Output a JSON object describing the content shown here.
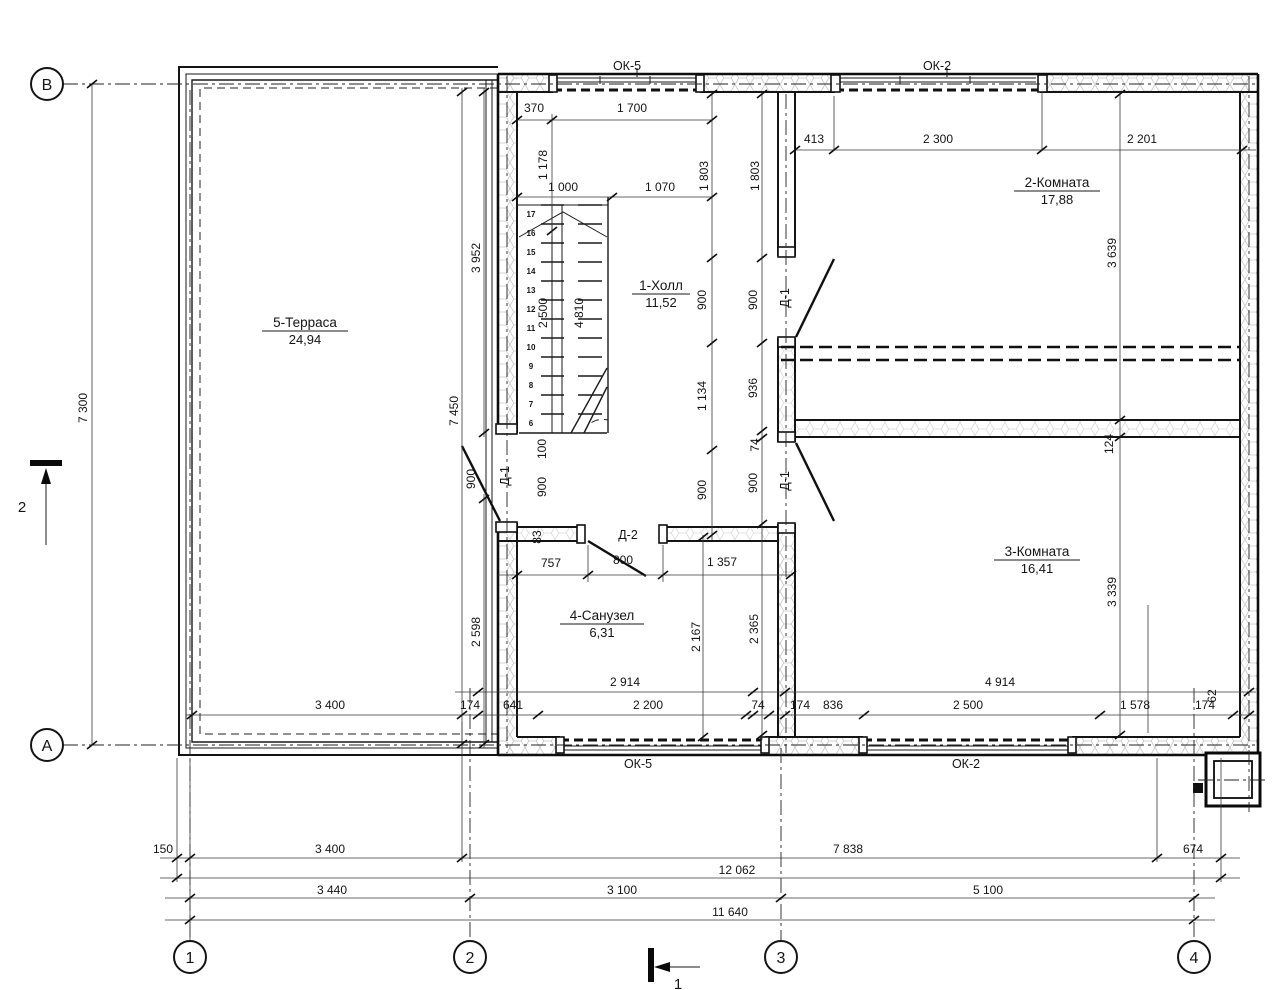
{
  "axes": {
    "horizontal": [
      "В",
      "А"
    ],
    "vertical": [
      "1",
      "2",
      "3",
      "4"
    ]
  },
  "rooms": [
    {
      "name": "5-Терраса",
      "area": "24,94"
    },
    {
      "name": "1-Холл",
      "area": "11,52"
    },
    {
      "name": "2-Комната",
      "area": "17,88"
    },
    {
      "name": "3-Комната",
      "area": "16,41"
    },
    {
      "name": "4-Санузел",
      "area": "6,31"
    }
  ],
  "windows": {
    "labels_top": [
      "ОК-5",
      "ОК-2"
    ],
    "labels_bottom": [
      "ОК-5",
      "ОК-2"
    ]
  },
  "doors": {
    "d1": "Д-1",
    "d2": "Д-2"
  },
  "sections": {
    "mark_left": "2",
    "mark_bottom": "1"
  },
  "stairs": {
    "step_numbers": [
      17,
      16,
      15,
      14,
      13,
      12,
      11,
      10,
      9,
      8,
      7,
      6
    ]
  },
  "dimensions": [
    {
      "t": "370",
      "x": 534,
      "y": 112
    },
    {
      "t": "1 700",
      "x": 632,
      "y": 112
    },
    {
      "t": "1 000",
      "x": 563,
      "y": 191
    },
    {
      "t": "1 070",
      "x": 660,
      "y": 191
    },
    {
      "t": "413",
      "x": 814,
      "y": 143
    },
    {
      "t": "2 300",
      "x": 938,
      "y": 143
    },
    {
      "t": "2 201",
      "x": 1142,
      "y": 143
    },
    {
      "t": "757",
      "x": 551,
      "y": 567
    },
    {
      "t": "800",
      "x": 623,
      "y": 564
    },
    {
      "t": "1 357",
      "x": 722,
      "y": 566
    },
    {
      "t": "2 914",
      "x": 625,
      "y": 686
    },
    {
      "t": "4 914",
      "x": 1000,
      "y": 686
    },
    {
      "t": "3 400",
      "x": 330,
      "y": 709
    },
    {
      "t": "174",
      "x": 470,
      "y": 709
    },
    {
      "t": "641",
      "x": 513,
      "y": 709
    },
    {
      "t": "2 200",
      "x": 648,
      "y": 709
    },
    {
      "t": "74",
      "x": 758,
      "y": 709
    },
    {
      "t": "174",
      "x": 800,
      "y": 709
    },
    {
      "t": "836",
      "x": 833,
      "y": 709
    },
    {
      "t": "2 500",
      "x": 968,
      "y": 709
    },
    {
      "t": "1 578",
      "x": 1135,
      "y": 709
    },
    {
      "t": "174",
      "x": 1205,
      "y": 709
    },
    {
      "t": "150",
      "x": 163,
      "y": 853
    },
    {
      "t": "3 400",
      "x": 330,
      "y": 853
    },
    {
      "t": "7 838",
      "x": 848,
      "y": 853
    },
    {
      "t": "674",
      "x": 1193,
      "y": 853
    },
    {
      "t": "12 062",
      "x": 737,
      "y": 874
    },
    {
      "t": "3 440",
      "x": 332,
      "y": 894
    },
    {
      "t": "3 100",
      "x": 622,
      "y": 894
    },
    {
      "t": "5 100",
      "x": 988,
      "y": 894
    },
    {
      "t": "11 640",
      "x": 730,
      "y": 916
    },
    {
      "t": "1 178",
      "x": 547,
      "y": 165,
      "r": 1
    },
    {
      "t": "1 803",
      "x": 708,
      "y": 176,
      "r": 1
    },
    {
      "t": "1 803",
      "x": 759,
      "y": 176,
      "r": 1
    },
    {
      "t": "3 952",
      "x": 480,
      "y": 258,
      "r": 1
    },
    {
      "t": "2 500",
      "x": 547,
      "y": 313,
      "r": 1
    },
    {
      "t": "4 810",
      "x": 583,
      "y": 313,
      "r": 1
    },
    {
      "t": "3 639",
      "x": 1116,
      "y": 253,
      "r": 1
    },
    {
      "t": "900",
      "x": 706,
      "y": 300,
      "r": 1
    },
    {
      "t": "1 134",
      "x": 706,
      "y": 396,
      "r": 1
    },
    {
      "t": "900",
      "x": 706,
      "y": 490,
      "r": 1
    },
    {
      "t": "900",
      "x": 757,
      "y": 300,
      "r": 1
    },
    {
      "t": "936",
      "x": 757,
      "y": 388,
      "r": 1
    },
    {
      "t": "74",
      "x": 759,
      "y": 445,
      "r": 1
    },
    {
      "t": "900",
      "x": 757,
      "y": 483,
      "r": 1
    },
    {
      "t": "7 300",
      "x": 87,
      "y": 408,
      "r": 1
    },
    {
      "t": "7 450",
      "x": 458,
      "y": 411,
      "r": 1
    },
    {
      "t": "2 598",
      "x": 480,
      "y": 632,
      "r": 1
    },
    {
      "t": "2 167",
      "x": 700,
      "y": 637,
      "r": 1
    },
    {
      "t": "2 365",
      "x": 758,
      "y": 629,
      "r": 1
    },
    {
      "t": "3 339",
      "x": 1116,
      "y": 592,
      "r": 1
    },
    {
      "t": "124",
      "x": 1113,
      "y": 444,
      "r": 1
    },
    {
      "t": "900",
      "x": 475,
      "y": 479,
      "r": 1
    },
    {
      "t": "100",
      "x": 546,
      "y": 449,
      "r": 1
    },
    {
      "t": "900",
      "x": 546,
      "y": 487,
      "r": 1
    },
    {
      "t": "83",
      "x": 541,
      "y": 537,
      "r": 1
    },
    {
      "t": "62",
      "x": 1216,
      "y": 696,
      "r": 1
    }
  ]
}
